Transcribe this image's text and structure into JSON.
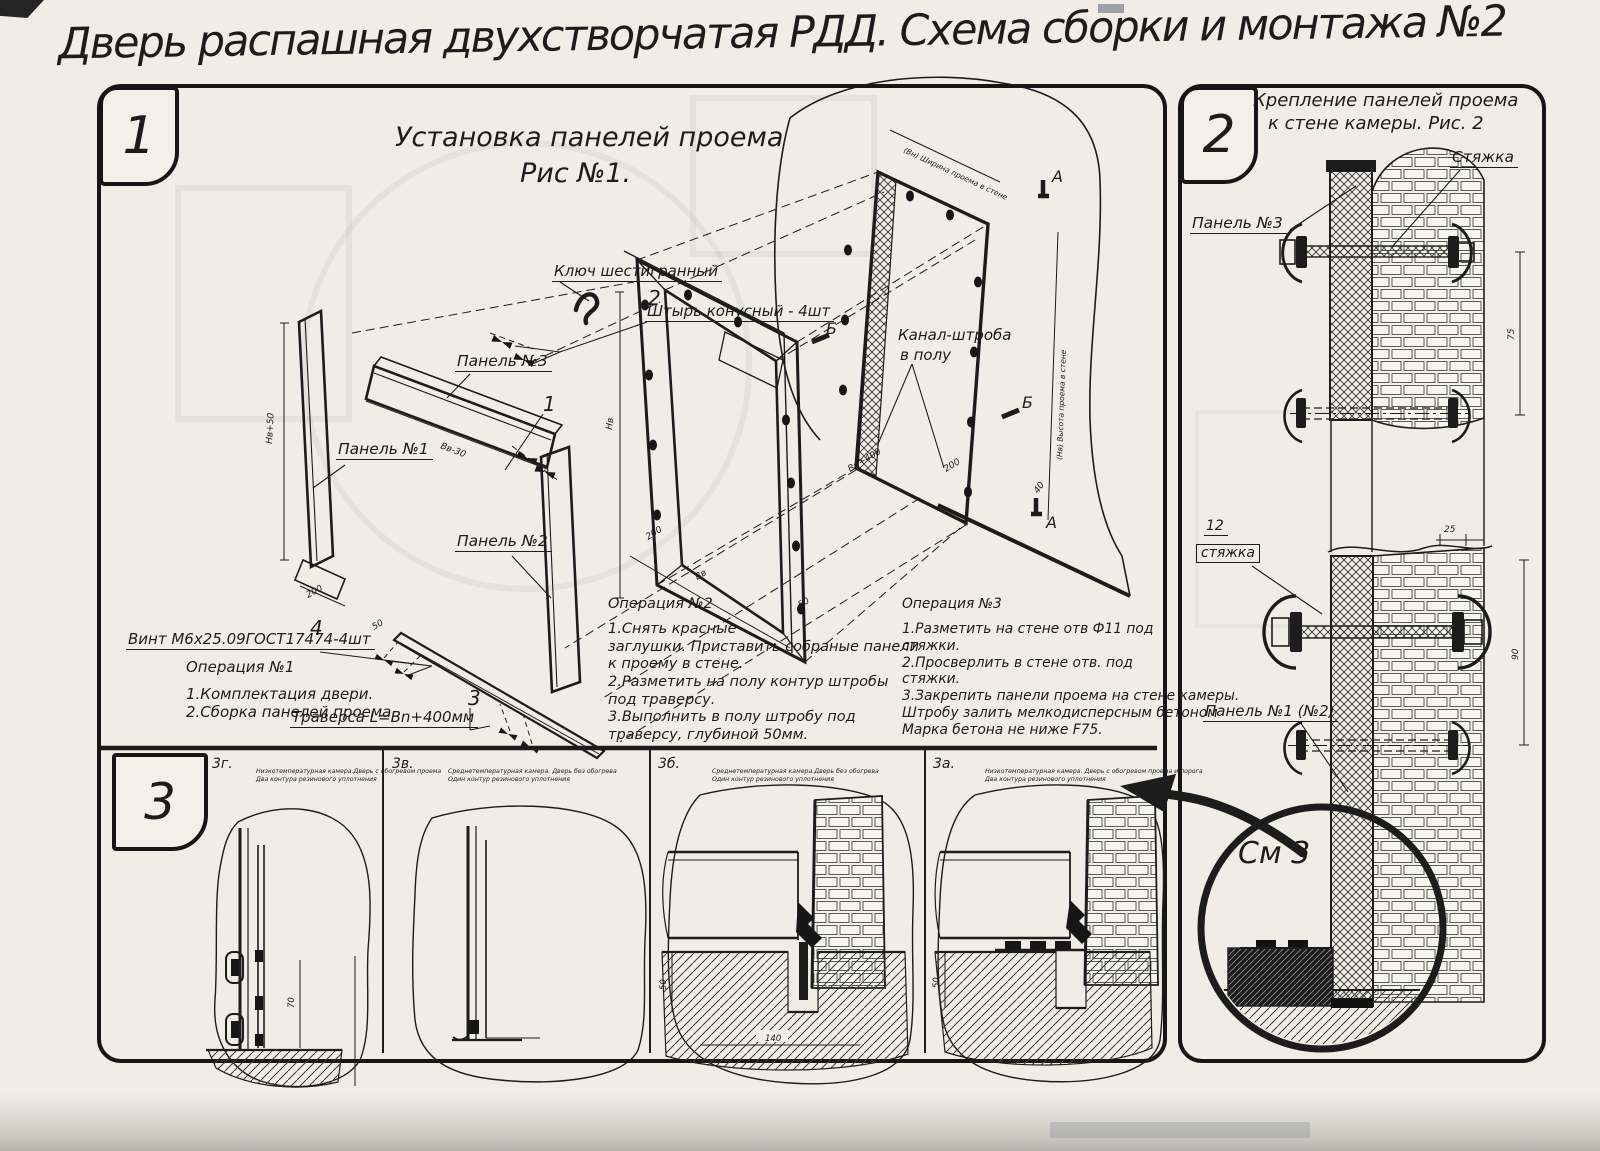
{
  "page": {
    "title": "Дверь распашная двухстворчатая РДД.  Схема сборки и монтажа №2"
  },
  "fig1": {
    "badge": "1",
    "title1": "Установка панелей проема",
    "title2": "Рис №1.",
    "callouts": {
      "hex_key": "Ключ шестигранный",
      "n2": "2",
      "pin": "Штырь конусный - 4шт",
      "panel3": "Панель №3",
      "n1": "1",
      "panel1": "Панель №1",
      "panel2": "Панель №2",
      "n4": "4",
      "screw": "Винт М6х25.09ГОСТ17474-4шт",
      "n3": "3",
      "traverse": "Траверса  L=Bn+400мм",
      "channel_l1": "Канал-штроба",
      "channel_l2": "в полу"
    },
    "marks": {
      "a_top": "А",
      "a_bot": "А",
      "b_left": "Б",
      "b_right": "Б"
    },
    "dims": {
      "d_h1": "Нв+50",
      "d200a": "200",
      "d_bv30": "Вв-30",
      "d50c": "50",
      "d_hv": "Нв",
      "d200b": "200",
      "d_bv": "Вв",
      "d50a": "50",
      "d_bn400": "Вн+400",
      "d200c": "200",
      "d40": "40",
      "open_w": "(Вн) Ширина проема в стене",
      "open_h": "(Нв) Высота проема в стене"
    },
    "op1": {
      "title": "Операция №1",
      "lines": [
        "1.Комплектация двери.",
        "2.Сборка панелей проема"
      ]
    },
    "op2": {
      "title": "Операция №2",
      "lines": [
        "1.Снять красные",
        "заглушки. Приставить собраные панели",
        "к проему в стене.",
        "2.Разметить на полу контур штробы",
        "под траверсу.",
        "3.Выполнить в полу штробу под",
        "траверсу, глубиной 50мм."
      ]
    },
    "op3": {
      "title": "Операция №3",
      "lines": [
        "1.Разметить на стене отв Ф11 под",
        "стяжки.",
        "2.Просверлить в стене отв.  под",
        "стяжки.",
        "3.Закрепить панели проема на стене камеры.",
        "Штробу залить мелкодисперсным бетоном",
        "Марка бетона не ниже  F75."
      ]
    }
  },
  "fig2": {
    "badge": "2",
    "title1": "Крепление панелей проема",
    "title2": "к стене камеры. Рис. 2",
    "callouts": {
      "tie": "Стяжка",
      "panel3": "Панель №3",
      "tie_no": "12",
      "tie_boxed": "стяжка",
      "panel12": "Панель №1 (№2)",
      "see": "См 3"
    },
    "dims": {
      "d25": "25",
      "d75": "75",
      "d90": "90"
    }
  },
  "fig3": {
    "badge": "3",
    "sections": [
      {
        "id": "3г.",
        "l1": "Низкотемпературная камера.Дверь с обогревом проема",
        "l2": "Два контура резинового уплотнения",
        "d70": "70"
      },
      {
        "id": "3в.",
        "l1": "Среднетемпературная камера. Дверь без обогрева",
        "l2": "Один контур резинового уплотнения"
      },
      {
        "id": "3б.",
        "l1": "Среднетемпературная камера.Дверь без обогрева",
        "l2": "Один контур резинового уплотнения",
        "d50": "50",
        "d140": "140"
      },
      {
        "id": "3а.",
        "l1": "Низкотемпературная камера. Дверь с обогревом проема и порога",
        "l2": "Два контура резинового уплотнения",
        "d50": "50"
      }
    ]
  }
}
